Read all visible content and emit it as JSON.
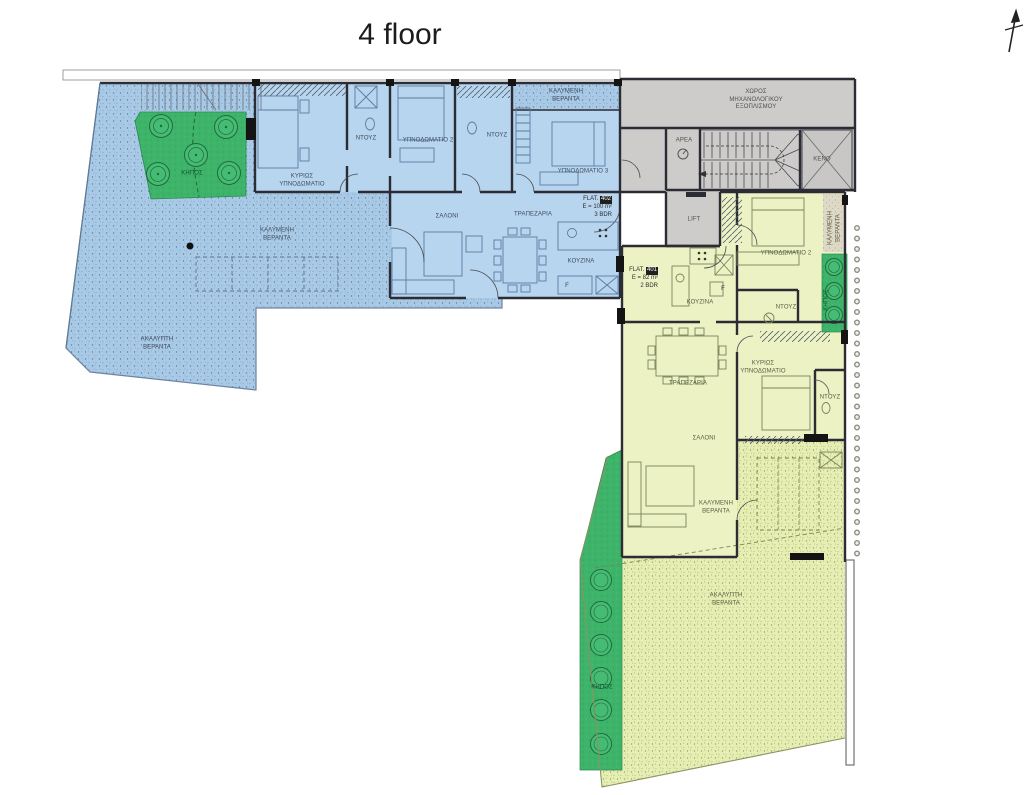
{
  "title": "4 floor",
  "flats": {
    "flat402": {
      "name": "FLAT.",
      "number": "402",
      "area": "E = 100 m²",
      "beds": "3 BDR"
    },
    "flat401": {
      "name": "FLAT.",
      "number": "401",
      "area": "E = 82 m²",
      "beds": "2 BDR"
    }
  },
  "rooms": {
    "blue": {
      "master": "ΚΥΡΙΩΣ ΥΠΝΟΔΩΜΑΤΙΟ",
      "bedroom2": "ΥΠΝΟΔΩΜΑΤΙΟ 2",
      "bedroom3": "ΥΠΝΟΔΩΜΑΤΙΟ 3",
      "shower_a": "ΝΤΟΥΖ",
      "shower_b": "ΝΤΟΥΖ",
      "living": "ΣΑΛΟΝΙ",
      "dining": "ΤΡΑΠΕΖΑΡΙΑ",
      "kitchen": "ΚΟΥΖΙΝΑ",
      "covered_veranda_top": "ΚΑΛΥΜΕΝΗ ΒΕΡΑΝΤΑ",
      "covered_veranda": "ΚΑΛΥΜΕΝΗ ΒΕΡΑΝΤΑ",
      "open_veranda": "ΑΚΑΛΥΠΤΗ ΒΕΡΑΝΤΑ",
      "garden": "ΚΗΠΟΣ"
    },
    "common": {
      "mechanical": "ΧΩΡΟΣ ΜΗΧΑΝΟΛΟΓΙΚΟΥ ΕΞΟΠΛΙΣΜΟΥ",
      "void": "ΚΕΝΟ",
      "lift": "LIFT",
      "meter": "ΑΡΕΑ"
    },
    "yellow": {
      "bedroom2": "ΥΠΝΟΔΩΜΑΤΙΟ 2",
      "shower_a": "ΝΤΟΥΖ",
      "kitchen": "ΚΟΥΖΙΝΑ",
      "dining": "ΤΡΑΠΕΖΑΡΙΑ",
      "master": "ΚΥΡΙΩΣ ΥΠΝΟΔΩΜΑΤΙΟ",
      "shower_b": "ΝΤΟΥΖ",
      "living": "ΣΑΛΟΝΙ",
      "covered_veranda_side": "ΚΑΛΥΜΕΝΗ ΒΕΡΑΝΤΑ",
      "covered_veranda": "ΚΑΛΥΜΕΝΗ ΒΕΡΑΝΤΑ",
      "open_veranda": "ΑΚΑΛΥΠΤΗ ΒΕΡΑΝΤΑ",
      "garden_side": "ΚΗΠΟΣ",
      "garden_bottom": "ΚΗΠΟΣ"
    }
  },
  "misc": {
    "fridge": "F"
  },
  "colors": {
    "apartment_blue": "#a9cae7",
    "apartment_blue_room": "#b7d5ee",
    "apartment_yellow_room": "#ecf2c4",
    "apartment_yellow_terrace": "#e7eeb4",
    "garden_green": "#3eb46a",
    "common_gray": "#cdccca",
    "wall": "#2c2c34"
  }
}
